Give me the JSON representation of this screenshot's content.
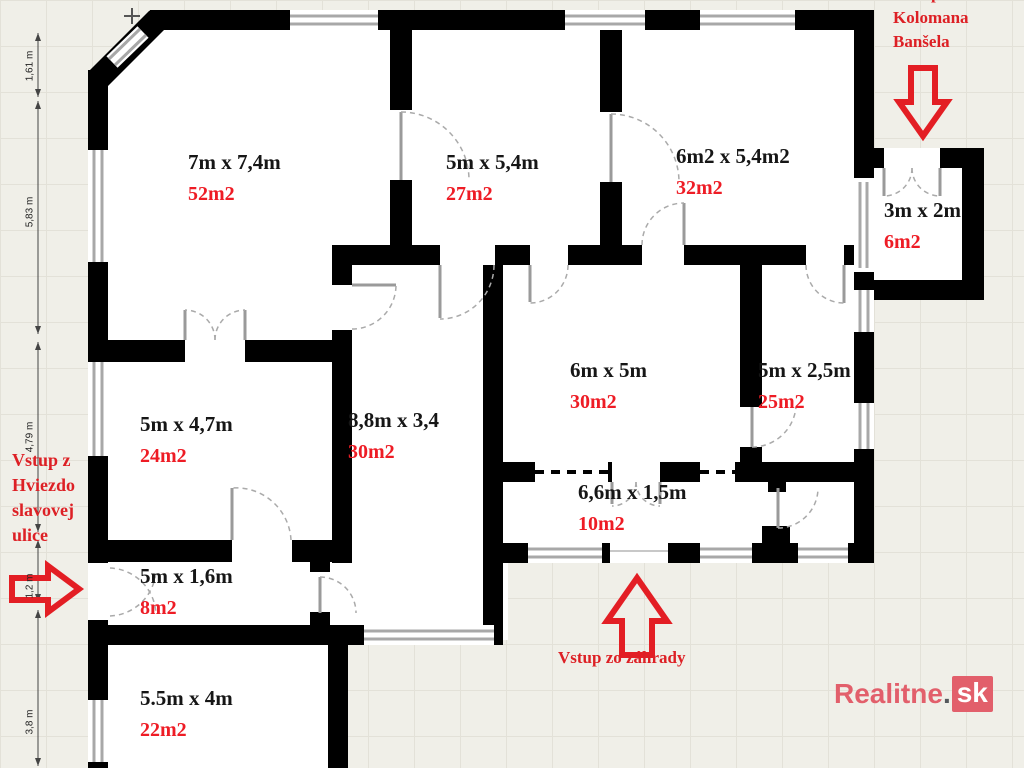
{
  "plan": {
    "rooms": [
      {
        "size": "7m x 7,4m",
        "area": "52m2"
      },
      {
        "size": "5m x 5,4m",
        "area": "27m2"
      },
      {
        "size": "6m2 x 5,4m2",
        "area": "32m2"
      },
      {
        "size": "3m x 2m",
        "area": "6m2"
      },
      {
        "size": "6m x 5m",
        "area": "30m2"
      },
      {
        "size": "5m x 2,5m",
        "area": "25m2"
      },
      {
        "size": "5m x 4,7m",
        "area": "24m2"
      },
      {
        "size": "8,8m x 3,4",
        "area": "30m2"
      },
      {
        "size": "6,6m x 1,5m",
        "area": "10m2"
      },
      {
        "size": "5m x 1,6m",
        "area": "8m2"
      },
      {
        "size": "5.5m x 4m",
        "area": "22m2"
      }
    ],
    "annotations": {
      "street_entrance_lines": [
        "Vstup z",
        "Hviezdo",
        "slavovej",
        "ulice"
      ],
      "top_entrance_partial": "p",
      "top_entrance_lines": [
        "Kolomana",
        "Banšela"
      ],
      "garden_entrance": "Vstup zo záhrady"
    },
    "dimensions_left": [
      "1,61 m",
      "5,83 m",
      "4,79 m",
      "1,2 m",
      "3,8 m"
    ],
    "watermark": {
      "name": "Realitne",
      "dot": ".",
      "tld": "sk"
    },
    "colors": {
      "annotation_red": "#dd2025",
      "area_red": "#ee1c25",
      "arrow_red": "#e31e24",
      "wall_black": "#000000",
      "watermark_pink": "#e25f6b",
      "background": "#f0efe8"
    }
  }
}
